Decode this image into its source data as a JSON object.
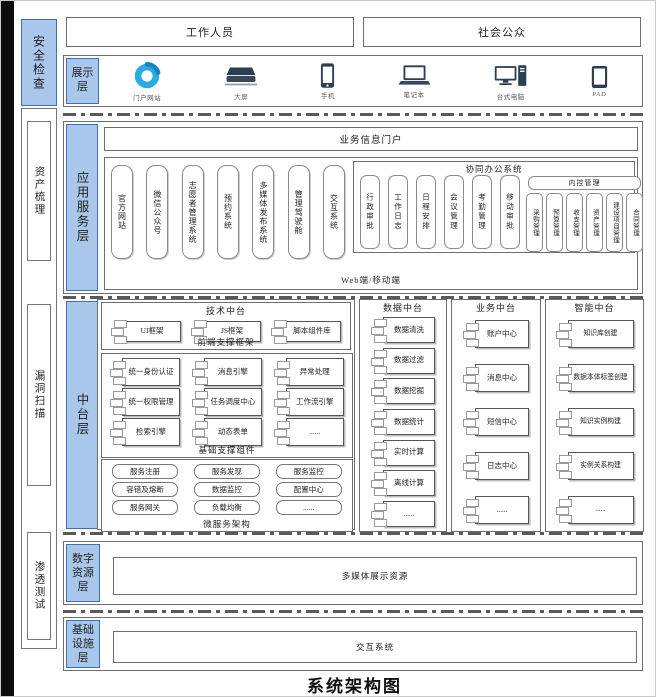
{
  "title": "系统架构图",
  "security_rail": {
    "top_label": "安全检查",
    "items": [
      "资产梳理",
      "漏洞扫描",
      "渗透测试"
    ]
  },
  "actors": {
    "staff": "工作人员",
    "public": "社会公众"
  },
  "display_layer": {
    "label": "展示层",
    "devices": [
      {
        "icon": "portal-icon",
        "label": "门户网站"
      },
      {
        "icon": "big-screen-icon",
        "label": "大屏"
      },
      {
        "icon": "phone-icon",
        "label": "手机"
      },
      {
        "icon": "laptop-icon",
        "label": "笔记本"
      },
      {
        "icon": "desktop-icon",
        "label": "台式电脑"
      },
      {
        "icon": "pad-icon",
        "label": "PAD"
      }
    ]
  },
  "app_layer": {
    "label": "应用服务层",
    "portal": "业务信息门户",
    "apps": [
      "官方网站",
      "微信公众号",
      "志愿者管理系统",
      "预约系统",
      "多媒体发布系统",
      "管理驾驶舱",
      "交互系统"
    ],
    "oa": {
      "title": "协同办公系统",
      "items": [
        "行政审批",
        "工作日志",
        "日程安排",
        "会议管理",
        "考勤管理",
        "移动审批"
      ],
      "internal_control": {
        "title": "内控管理",
        "items": [
          "采购管理",
          "预算管理",
          "收支管理",
          "资产管理",
          "建设项目管理",
          "合同管理"
        ]
      }
    },
    "footer": "Web端/移动端"
  },
  "middle_layer": {
    "label": "中台层",
    "tech": {
      "title": "技术中台",
      "frontend": {
        "items": [
          "UI框架",
          "JS框架",
          "脚本组件库"
        ],
        "caption": "前端支撑框架"
      },
      "base": {
        "items": [
          "统一身份认证",
          "消息引擎",
          "异常处理",
          "统一权限管理",
          "任务调度中心",
          "工作流引擎",
          "检索引擎",
          "动态表单",
          "......"
        ],
        "caption": "基础支撑组件"
      },
      "micro": {
        "items": [
          "服务注册",
          "服务发现",
          "服务监控",
          "容错及熔断",
          "数据监控",
          "配置中心",
          "服务网关",
          "负载均衡",
          "......"
        ],
        "caption": "微服务架构"
      }
    },
    "data": {
      "title": "数据中台",
      "items": [
        "数据清洗",
        "数据过滤",
        "数据挖掘",
        "数据统计",
        "实时计算",
        "离线计算",
        "......"
      ]
    },
    "business": {
      "title": "业务中台",
      "items": [
        "账户中心",
        "消息中心",
        "短信中心",
        "日志中心",
        "......"
      ]
    },
    "intelligence": {
      "title": "智能中台",
      "items": [
        "知识库创建",
        "数据本体标签创建",
        "知识实例构建",
        "实例关系构建",
        "......"
      ]
    }
  },
  "resource_layer": {
    "label": "数字资源层",
    "content": "多媒体展示资源"
  },
  "infra_layer": {
    "label": "基础设施层",
    "content": "交互系统"
  },
  "colors": {
    "accent_fill": "#a9c7ea",
    "accent_border": "#3f6fae",
    "portal_blue": "#29abe2",
    "icon_navy": "#2c3e50"
  }
}
